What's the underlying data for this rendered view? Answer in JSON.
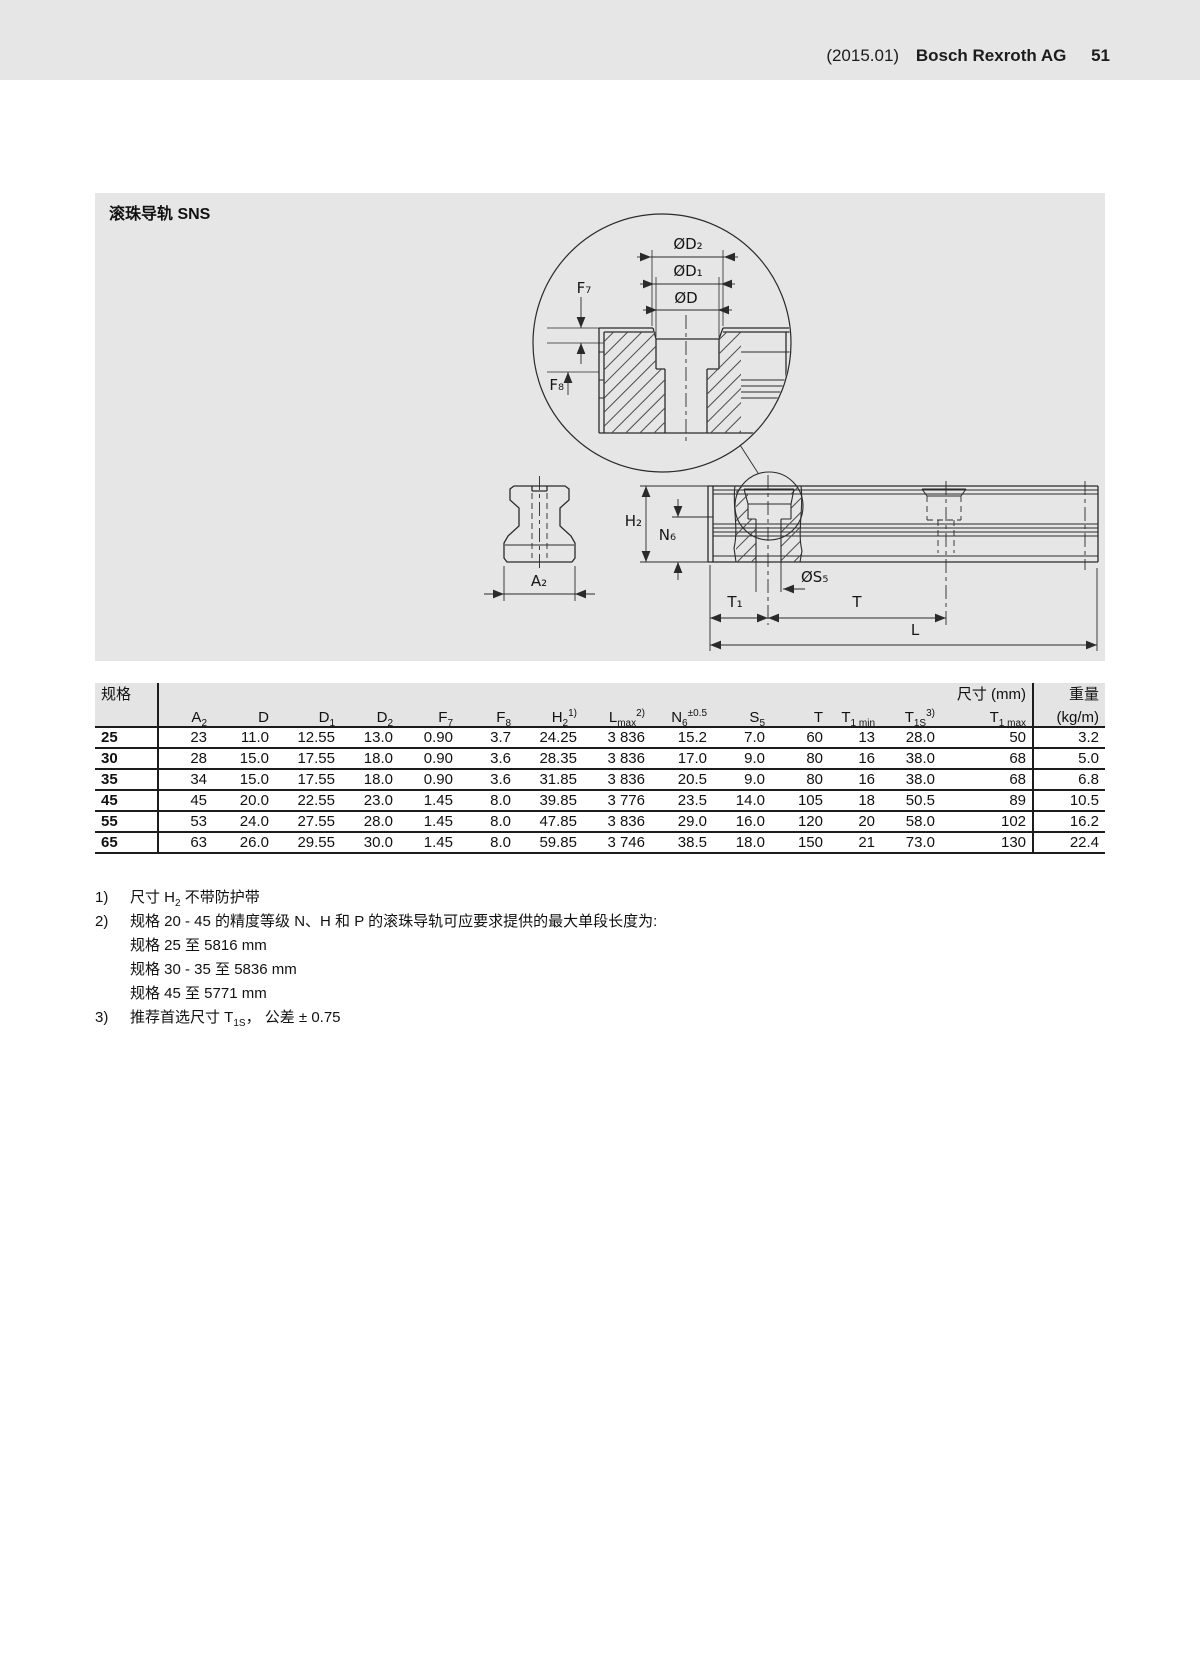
{
  "page_header": {
    "edition": "(2015.01)",
    "company": "Bosch Rexroth AG",
    "page_number": "51"
  },
  "figure": {
    "title": "滚珠导轨 SNS",
    "labels": {
      "od2": "ØD₂",
      "od1": "ØD₁",
      "od": "ØD",
      "f7": "F₇",
      "f8": "F₈",
      "h2": "H₂",
      "n6": "N₆",
      "os5": "ØS₅",
      "t1": "T₁",
      "t": "T",
      "l": "L",
      "a2": "A₂"
    }
  },
  "table": {
    "spec_label": "规格",
    "size_label": "尺寸 (mm)",
    "weight_label": "重量",
    "weight_unit": "(kg/m)",
    "columns": [
      [
        {
          "t": "A"
        },
        {
          "t": "2",
          "s": "sub"
        }
      ],
      [
        {
          "t": "D"
        }
      ],
      [
        {
          "t": "D"
        },
        {
          "t": "1",
          "s": "sub"
        }
      ],
      [
        {
          "t": "D"
        },
        {
          "t": "2",
          "s": "sub"
        }
      ],
      [
        {
          "t": "F"
        },
        {
          "t": "7",
          "s": "sub"
        }
      ],
      [
        {
          "t": "F"
        },
        {
          "t": "8",
          "s": "sub"
        }
      ],
      [
        {
          "t": "H"
        },
        {
          "t": "2",
          "s": "sub"
        },
        {
          "t": "1)",
          "s": "sup"
        }
      ],
      [
        {
          "t": "L"
        },
        {
          "t": "max",
          "s": "sub"
        },
        {
          "t": "2)",
          "s": "sup"
        }
      ],
      [
        {
          "t": "N"
        },
        {
          "t": "6",
          "s": "sub"
        },
        {
          "t": "±0.5",
          "s": "sup"
        }
      ],
      [
        {
          "t": "S"
        },
        {
          "t": "5",
          "s": "sub"
        }
      ],
      [
        {
          "t": "T"
        }
      ],
      [
        {
          "t": "T"
        },
        {
          "t": "1 min",
          "s": "sub"
        }
      ],
      [
        {
          "t": "T"
        },
        {
          "t": "1S",
          "s": "sub"
        },
        {
          "t": "3)",
          "s": "sup"
        }
      ],
      [
        {
          "t": "T"
        },
        {
          "t": "1 max",
          "s": "sub"
        }
      ]
    ],
    "rows": [
      {
        "spec": "25",
        "values": [
          "23",
          "11.0",
          "12.55",
          "13.0",
          "0.90",
          "3.7",
          "24.25",
          "3 836",
          "15.2",
          "7.0",
          "60",
          "13",
          "28.0",
          "50"
        ],
        "weight": "3.2"
      },
      {
        "spec": "30",
        "values": [
          "28",
          "15.0",
          "17.55",
          "18.0",
          "0.90",
          "3.6",
          "28.35",
          "3 836",
          "17.0",
          "9.0",
          "80",
          "16",
          "38.0",
          "68"
        ],
        "weight": "5.0"
      },
      {
        "spec": "35",
        "values": [
          "34",
          "15.0",
          "17.55",
          "18.0",
          "0.90",
          "3.6",
          "31.85",
          "3 836",
          "20.5",
          "9.0",
          "80",
          "16",
          "38.0",
          "68"
        ],
        "weight": "6.8"
      },
      {
        "spec": "45",
        "values": [
          "45",
          "20.0",
          "22.55",
          "23.0",
          "1.45",
          "8.0",
          "39.85",
          "3 776",
          "23.5",
          "14.0",
          "105",
          "18",
          "50.5",
          "89"
        ],
        "weight": "10.5"
      },
      {
        "spec": "55",
        "values": [
          "53",
          "24.0",
          "27.55",
          "28.0",
          "1.45",
          "8.0",
          "47.85",
          "3 836",
          "29.0",
          "16.0",
          "120",
          "20",
          "58.0",
          "102"
        ],
        "weight": "16.2"
      },
      {
        "spec": "65",
        "values": [
          "63",
          "26.0",
          "29.55",
          "30.0",
          "1.45",
          "8.0",
          "59.85",
          "3 746",
          "38.5",
          "18.0",
          "150",
          "21",
          "73.0",
          "130"
        ],
        "weight": "22.4"
      }
    ]
  },
  "footnotes": [
    {
      "marker": "1)",
      "segments": [
        {
          "t": "尺寸 H"
        },
        {
          "t": "2",
          "s": "sub"
        },
        {
          "t": " 不带防护带"
        }
      ]
    },
    {
      "marker": "2)",
      "segments": [
        {
          "t": "规格 20 - 45 的精度等级 N、H 和 P 的滚珠导轨可应要求提供的最大单段长度为:"
        }
      ]
    },
    {
      "marker": "",
      "segments": [
        {
          "t": "规格 25 至 5816 mm"
        }
      ]
    },
    {
      "marker": "",
      "segments": [
        {
          "t": "规格 30 - 35 至 5836 mm"
        }
      ]
    },
    {
      "marker": "",
      "segments": [
        {
          "t": "规格 45 至 5771 mm"
        }
      ]
    },
    {
      "marker": "3)",
      "segments": [
        {
          "t": "推荐首选尺寸 T"
        },
        {
          "t": "1S",
          "s": "sub"
        },
        {
          "t": "， 公差 ± 0.75"
        }
      ]
    }
  ]
}
